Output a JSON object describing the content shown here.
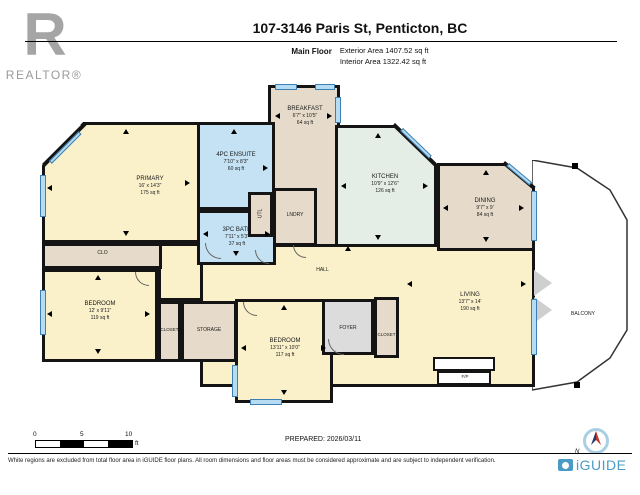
{
  "header": {
    "realtor_logo_letter": "R",
    "realtor_text": "REALTOR®",
    "title": "107-3146 Paris St, Penticton, BC",
    "floor_label": "Main Floor",
    "exterior_area": "Exterior Area 1407.52 sq ft",
    "interior_area": "Interior Area 1322.42 sq ft"
  },
  "rooms": {
    "primary": {
      "name": "PRIMARY",
      "dims": "16' x 14'3\"",
      "area": "175 sq ft"
    },
    "ensuite": {
      "name": "4PC ENSUITE",
      "dims": "7'10\" x 8'3\"",
      "area": "60 sq ft"
    },
    "bath": {
      "name": "3PC BATH",
      "dims": "7'11\" x 5'3\"",
      "area": "37 sq ft"
    },
    "breakfast": {
      "name": "BREAKFAST",
      "dims": "6'7\" x 10'5\"",
      "area": "64 sq ft"
    },
    "kitchen": {
      "name": "KITCHEN",
      "dims": "10'9\" x 12'6\"",
      "area": "126 sq ft"
    },
    "dining": {
      "name": "DINING",
      "dims": "9'7\" x 9'",
      "area": "84 sq ft"
    },
    "bedroom1": {
      "name": "BEDROOM",
      "dims": "12' x 9'11\"",
      "area": "119 sq ft"
    },
    "bedroom2": {
      "name": "BEDROOM",
      "dims": "13'11\" x 10'0\"",
      "area": "117 sq ft"
    },
    "living": {
      "name": "LIVING",
      "dims": "13'7\" x 14'",
      "area": "190 sq ft"
    },
    "hall": {
      "name": "HALL"
    },
    "foyer": {
      "name": "FOYER"
    },
    "clo": {
      "name": "CLO"
    },
    "closet1": {
      "name": "CLOSET"
    },
    "closet2": {
      "name": "CLOSET"
    },
    "storage": {
      "name": "STORAGE"
    },
    "utl": {
      "name": "UTL"
    },
    "lndry": {
      "name": "LNDRY"
    },
    "balcony": {
      "name": "BALCONY"
    },
    "fireplace": {
      "name": "F/P"
    }
  },
  "scale_bar": {
    "tick_0": "0",
    "tick_5": "5",
    "tick_10": "10",
    "unit": "ft"
  },
  "compass": {
    "north_label": "N"
  },
  "footer": {
    "prepared": "PREPARED: 2026/03/11",
    "disclaimer": "White regions are excluded from total floor area in iGUIDE floor plans. All room dimensions and floor areas must be considered approximate and are subject to independent verification.",
    "brand": "iGUIDE"
  },
  "icons": {
    "realtor_logo": "realtor-block-r-logo",
    "compass": "compass-north-icon",
    "iguide_logo": "iguide-camera-icon",
    "measure_arrows": "small black triangles on room walls",
    "windows": "blue window segments in walls"
  },
  "colors": {
    "wall": "#141414",
    "window_blue": "#4d94c7",
    "room_cream": "#faf1cb",
    "room_tan": "#e6dbca",
    "room_bath_blue": "#c4e2f4",
    "room_kitchen_mint": "#e4eee6",
    "foyer_gray": "#dcdcdc",
    "brand_blue": "#4a9cc7",
    "logo_gray": "#a5a5a5"
  }
}
